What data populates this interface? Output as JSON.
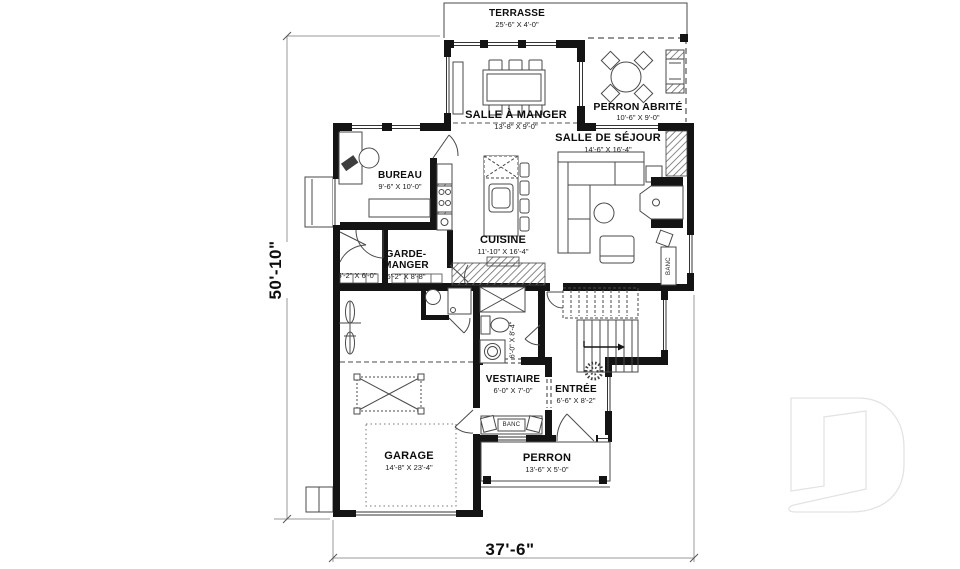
{
  "plan": {
    "type": "architectural floor plan",
    "language": "fr",
    "overall": {
      "width": "37'-6\"",
      "height": "50'-10\""
    },
    "rooms": [
      {
        "id": "terrasse",
        "name": "TERRASSE",
        "dims": "25'-6\" X 4'-0\""
      },
      {
        "id": "perron-abrite",
        "name": "PERRON ABRITÉ",
        "dims": "10'-6\" X 9'-0\""
      },
      {
        "id": "salle-a-manger",
        "name": "SALLE À MANGER",
        "dims": "13'-8\" X 9'-0\""
      },
      {
        "id": "salle-de-sejour",
        "name": "SALLE DE SÉJOUR",
        "dims": "14'-6\" X 16'-4\""
      },
      {
        "id": "bureau",
        "name": "BUREAU",
        "dims": "9'-6\" X 10'-0\""
      },
      {
        "id": "cuisine",
        "name": "CUISINE",
        "dims": "11'-10\" X 16'-4\""
      },
      {
        "id": "garde-manger",
        "name": "GARDE-MANGER",
        "dims": "6'-2\" X 8'-8\""
      },
      {
        "id": "rangement",
        "name": "",
        "dims": "5'-2\" X 6'-0\""
      },
      {
        "id": "salle-eau",
        "name": "",
        "dims": "6'-0\" X 8'-4\""
      },
      {
        "id": "vestiaire",
        "name": "VESTIAIRE",
        "dims": "6'-0\" X 7'-0\""
      },
      {
        "id": "entree",
        "name": "ENTRÉE",
        "dims": "6'-6\" X 8'-2\""
      },
      {
        "id": "garage",
        "name": "GARAGE",
        "dims": "14'-8\" X 23'-4\""
      },
      {
        "id": "perron",
        "name": "PERRON",
        "dims": "13'-6\" X 5'-0\""
      }
    ],
    "fixtures": [
      {
        "id": "banc-vestiaire",
        "label": "BANC"
      },
      {
        "id": "banc-sejour",
        "label": "BANC"
      }
    ],
    "colors": {
      "wall": "#141414",
      "line": "#444444",
      "dashed": "#555555",
      "background": "#ffffff",
      "watermark_outline": "#e3e3e3"
    }
  }
}
